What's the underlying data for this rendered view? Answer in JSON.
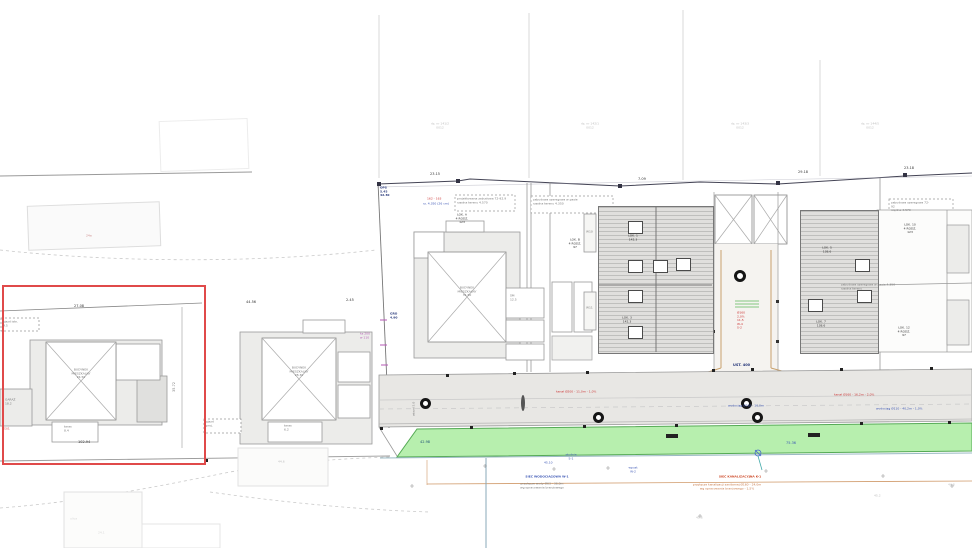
{
  "parcels": {
    "p1": "dz. nr 141/2\n0012",
    "p2": "dz. nr 142/1\n0012",
    "p3": "dz. nr 143/3\n0012",
    "p4": "dz. nr 144/5\n0012"
  },
  "left_area": {
    "faint_building": "24a",
    "dim_top": "27.08",
    "entry_box": "zjazd istn.\n4.5",
    "house_label": "BUDYNEK\nMIESZKALNY\n24.50",
    "annex_label": "GARAŻ\n18.2",
    "porch_label": "taras\n8.4",
    "dim_bottom": "102.94",
    "dim_side": "35.72",
    "red_note": "23/1"
  },
  "mid_area": {
    "dim_top": "44.56",
    "dim_top2": "2.45",
    "house_label": "BUDYNEK\nMIESZKALNY\n28.30",
    "porch_label": "taras\n6.2",
    "entry_box": "zjazd\nproj.",
    "bottom_dim": "44.6"
  },
  "boundary": {
    "magenta_note": "ks 200\nw 110",
    "navy_note": "GRO\n4.90",
    "corner_note": "OPS\n5.45\n42.30"
  },
  "complex": {
    "dim1": "23.15",
    "dim2": "7.09",
    "dim3": "29.18",
    "dim4": "23.18",
    "note_red": "162 - 163",
    "note_blue": "rz. 4.350 (26 cm)",
    "dashed_note1": "projektowana zabudowa  72-92.9\nrzędna terenu  4.570",
    "dashed_note2": "zabudowa szeregowa w pasie\nrzędna terenu  4.350",
    "dashed_note3": "zabudowa szeregowa  72-92\nrzędna  4.570",
    "dashed_note4": "zabudowa szeregowa w pasie  4.350\nrzędna terenu",
    "house_label": "BUDYNEK\nMIESZKALNY\n31.50",
    "lok_a": "LOK. A\n4 RODZ.\n123",
    "lok_b": "LOK. B\n4 RODZ.\n97",
    "lok_10": "LOK. 10\n4 RODZ.\n123",
    "lok_12": "LOK. 12\n4 RODZ.\n97",
    "room1": "ŚM\n12.5",
    "w10": "W10",
    "w11": "W11",
    "hatch_a1": "LOK. 1\n142.3",
    "hatch_a2": "LOK. 3\n142.3",
    "hatch_b1": "LOK. 5\n138.6",
    "hatch_b2": "LOK. 7\n138.6",
    "ust": "UST. 400",
    "red_stack": "Ø160\n2,0%\n11,5\nW-4\nS-2"
  },
  "road": {
    "red1": "kanał Ø200 - 11,0m - 1,0%",
    "red2": "kanał Ø160 - 16,2m - 2,0%",
    "blue1": "wodociąg Ø110 - 16,0m",
    "blue2": "wodociąg Ø110 - 40,2m - 1,0%",
    "rot_label": "wjazd 5,0"
  },
  "green": {
    "dim_left": "42.98",
    "dim_right": "75.36"
  },
  "below": {
    "s1": "studnia\nS-1",
    "s3": "45.10",
    "w2": "wpust\nW-2",
    "blue_title": "SIEĆ WODOCIĄGOWA  W-1",
    "blue_sub": "przyłącze wody Ø63 - 36,0m\nwg opracowania branżowego",
    "red_title": "SIEĆ KANALIZACYJNA  K-1",
    "red_sub": "przyłącze kanalizacji sanitarnej Ø160 - 24,0m\nwg opracowania branżowego - 1,5%",
    "g1": "45.2",
    "g2": "44.8",
    "g3": "45.6",
    "street": "ulica",
    "street2": "24.1"
  },
  "colors": {
    "highlight": "#e04a4a",
    "green_fill": "#b7efae",
    "road_fill": "#e8e7e4",
    "red_text": "#cc3333",
    "blue_text": "#3a55b4"
  }
}
